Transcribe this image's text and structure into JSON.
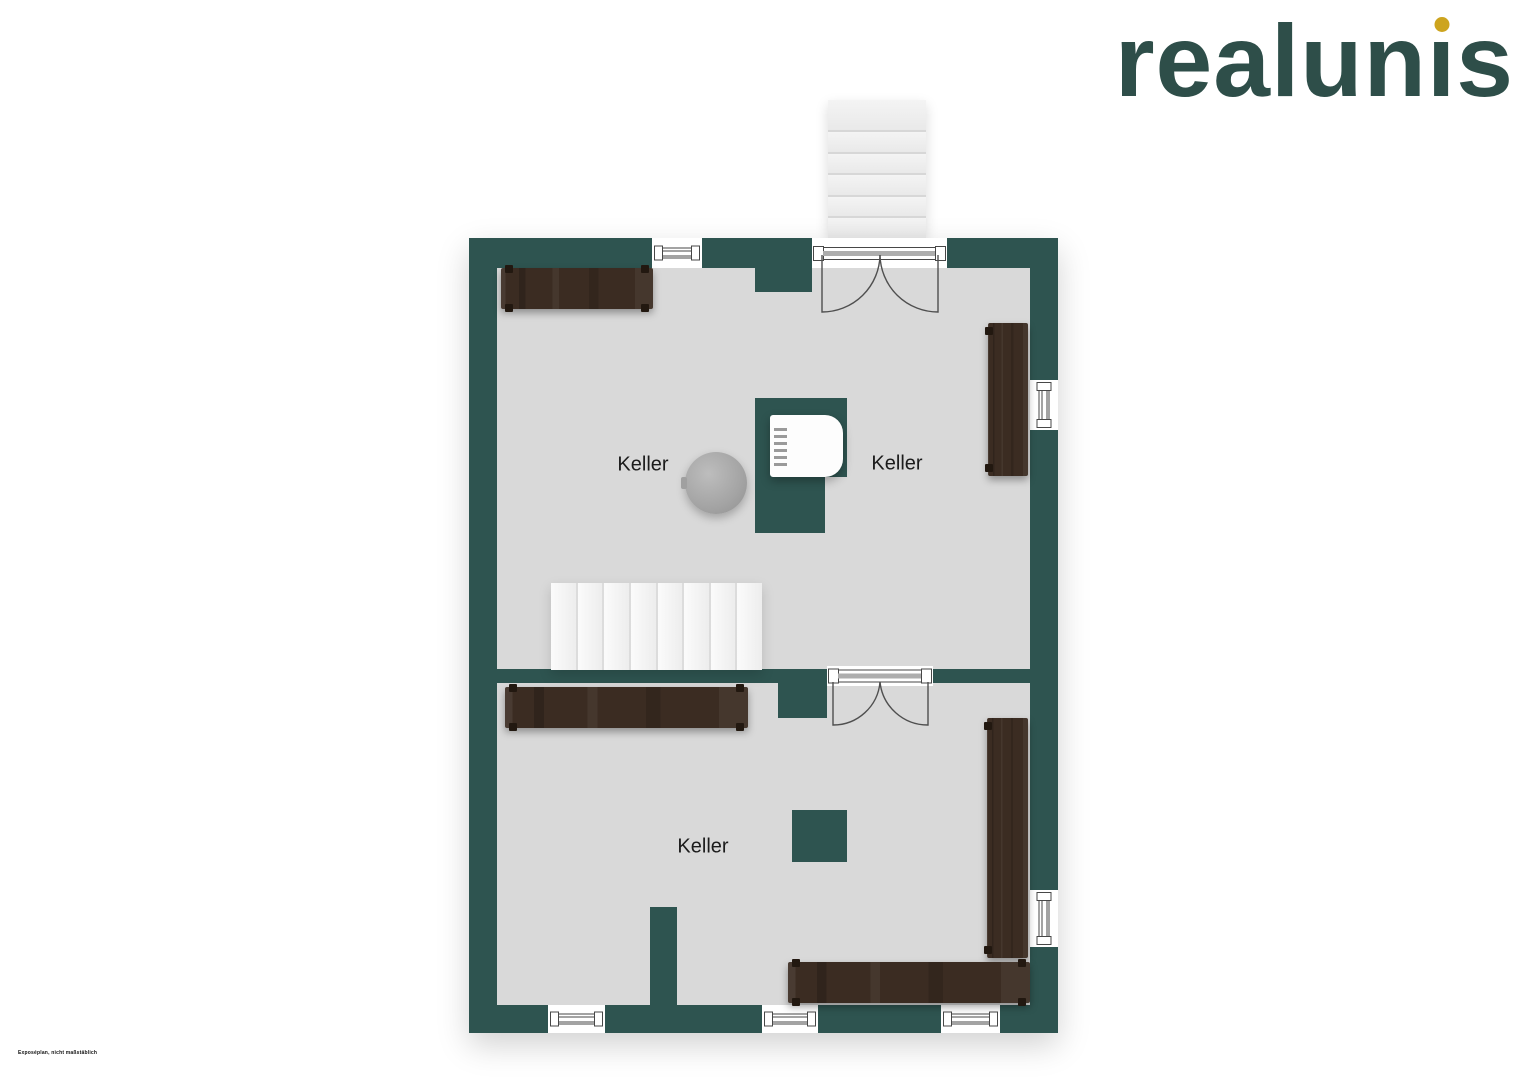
{
  "brand": {
    "logo_text": "realunis",
    "logo_before_i": "realun",
    "logo_i_char": "ı",
    "logo_after_i": "s"
  },
  "rooms": [
    {
      "label": "Keller"
    },
    {
      "label": "Keller"
    },
    {
      "label": "Keller"
    }
  ],
  "footer": {
    "disclaimer": "Exposéplan, nicht maßstäblich"
  },
  "colors": {
    "wall": "#2e5450",
    "floor": "#d9d9d9",
    "wood": "#3b2c22",
    "line": "#474747",
    "logo_text": "#2e4e49",
    "logo_dot": "#cda41e"
  }
}
